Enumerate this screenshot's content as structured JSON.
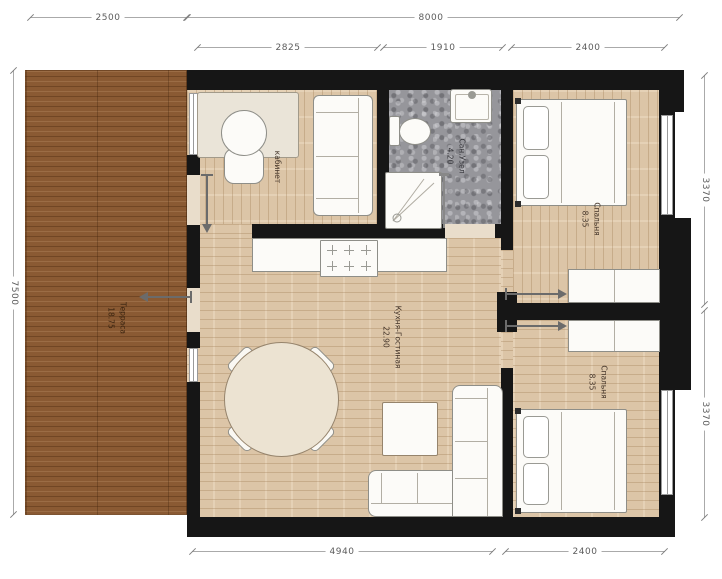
{
  "dimensions": {
    "terrace_width": "2500",
    "total_width": "8000",
    "office_width": "2825",
    "bathroom_width": "1910",
    "bedroom1_width": "2400",
    "total_height": "7500",
    "bedroom1_height": "3370",
    "bedroom2_height": "3370",
    "living_width": "4940",
    "bedroom2_width": "2400"
  },
  "rooms": {
    "terrace": {
      "name": "Терраса",
      "area": "18.75"
    },
    "office": {
      "name": "кабинет",
      "area": ""
    },
    "bathroom": {
      "name": "Сан.Узел",
      "area": "4.20"
    },
    "bedroom1": {
      "name": "Спальня",
      "area": "8.35"
    },
    "living": {
      "name": "Кухня-Гостиная",
      "area": "22.90"
    },
    "bedroom2": {
      "name": "Спальня",
      "area": "8.35"
    }
  },
  "colors": {
    "wall": "#161616",
    "terrace_wood": "#8a5a33",
    "interior_floor": "#dcc5a7",
    "bathroom_tile": "#96969b"
  }
}
